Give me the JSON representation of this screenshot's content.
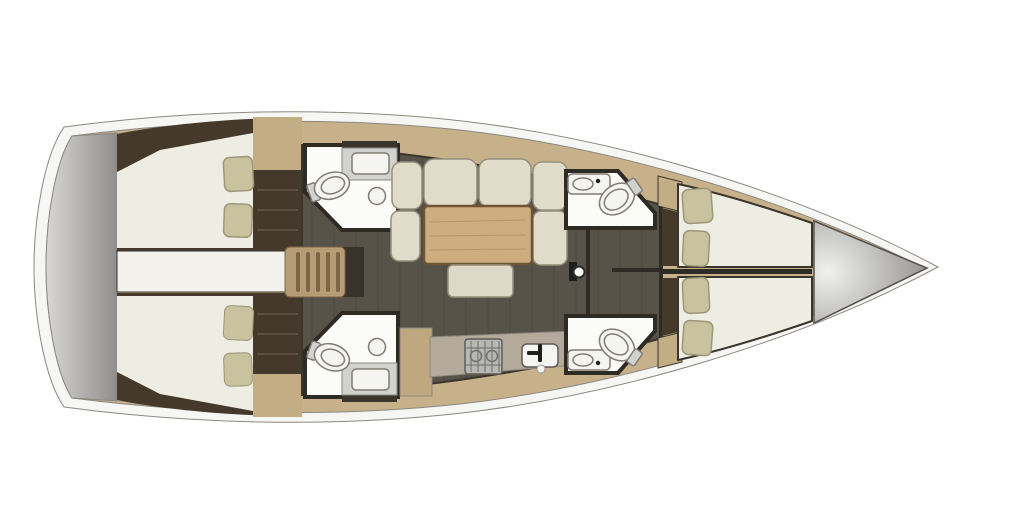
{
  "diagram": {
    "type": "yacht-interior-floor-plan",
    "view": "top-down",
    "orientation": "bow-right"
  },
  "colors": {
    "canvas_bg": "#ffffff",
    "hull_white": "#f6f6f4",
    "hull_stroke": "#a3a3a1",
    "deck_tan": "#c7b18a",
    "side_deck_tan": "#c3ad85",
    "platform_light": "#d8d7d5",
    "platform_dark": "#8f8e8c",
    "cabin_dark_brown": "#45392c",
    "bed_white": "#eeede3",
    "pillow_beige": "#c9c29f",
    "pillow_stroke": "#9d9678",
    "corridor_white": "#f2f1eb",
    "steps_tan": "#b79d75",
    "steps_slat": "#7c6646",
    "steps_shadow": "#38322a",
    "floor_dark": "#585349",
    "wall_dark": "#2e2b25",
    "bathroom_white": "#fbfbf8",
    "fixture_white": "#f4f4f1",
    "counter_gray": "#d2d2ce",
    "counter_dark_strip": "#3a362e",
    "sofa_cream": "#e0dcc9",
    "table_wood": "#cdac80",
    "bench_cream": "#ddd9c6",
    "galley_cabinet_tan": "#bfa87f",
    "galley_counter": "#b3aa9c",
    "stove_gray": "#b7b7b3",
    "sink_white": "#f4f4f2",
    "bow_locker_light": "#f0f0ee",
    "bow_locker_dark": "#8a8987",
    "mast_white": "#fdfdfb",
    "black_detail": "#1e1e1c"
  }
}
